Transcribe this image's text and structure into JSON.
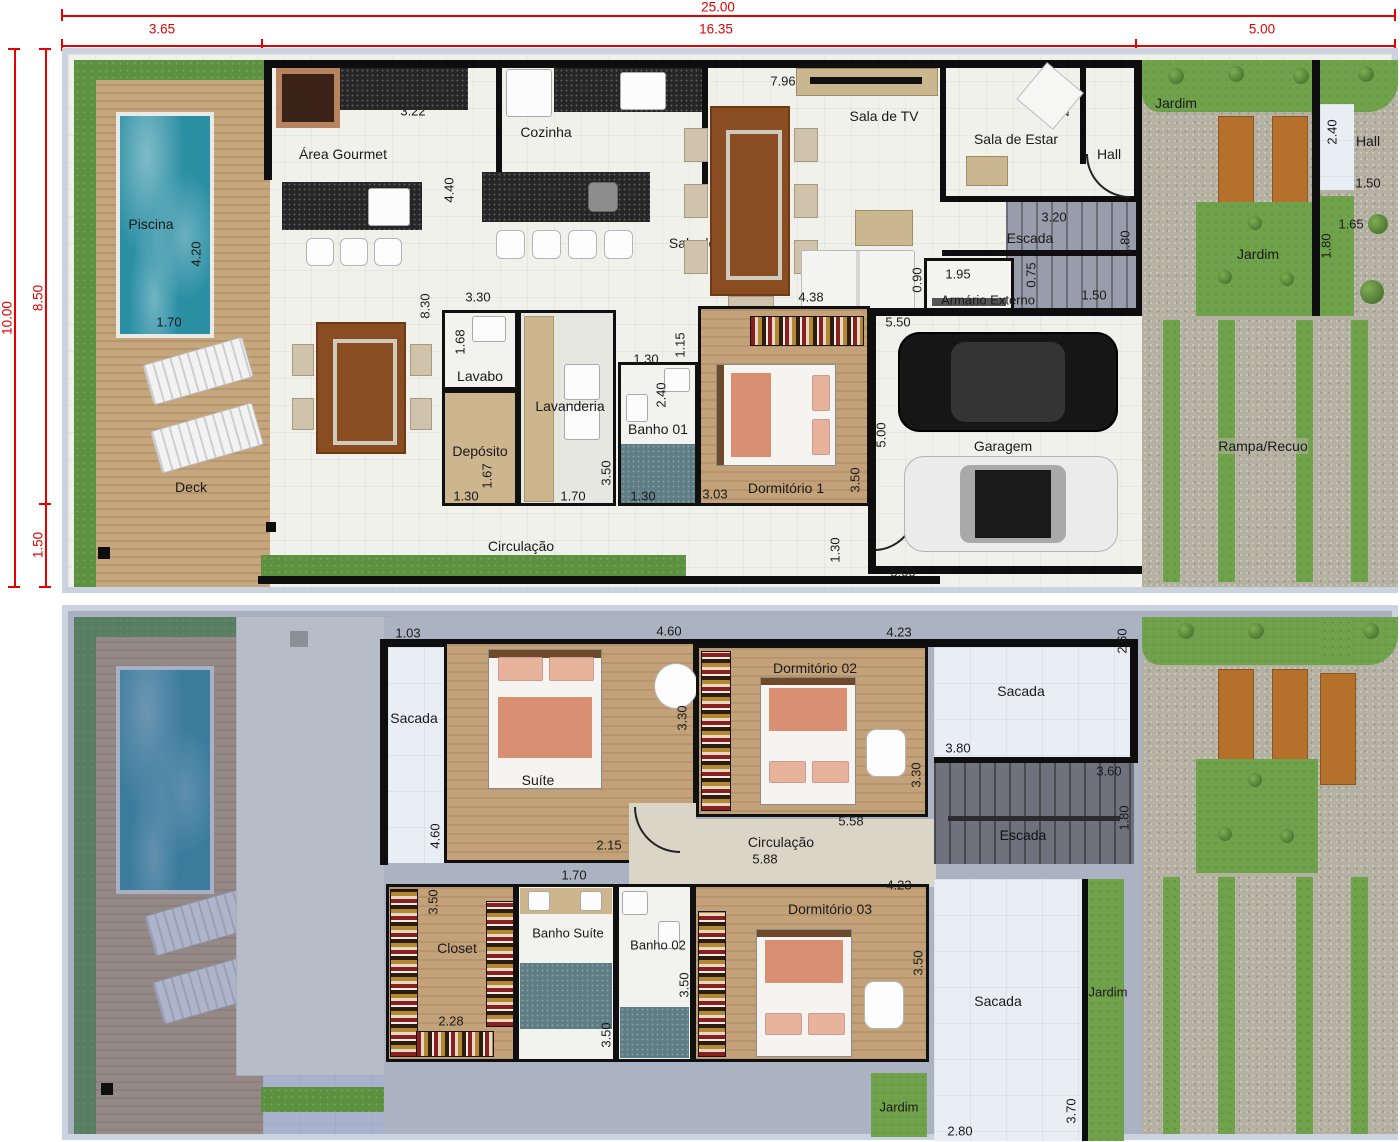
{
  "outer_dims": {
    "top_total": "25.00",
    "top_a": "3.65",
    "top_b": "16.35",
    "top_c": "5.00",
    "left_total": "10.00",
    "left_a": "8.50",
    "left_b": "1.50"
  },
  "floor1": {
    "rooms": {
      "piscina": "Piscina",
      "deck": "Deck",
      "area_gourmet": "Área Gourmet",
      "cozinha": "Cozinha",
      "sala_jantar": "Sala de Jantar",
      "sala_tv": "Sala de TV",
      "sala_estar": "Sala de Estar",
      "hall": "Hall",
      "hall_ext": "Hall",
      "jardim_top": "Jardim",
      "jardim_right": "Jardim",
      "escada": "Escada",
      "armario": "Armário Externo",
      "lavabo": "Lavabo",
      "lavanderia": "Lavanderia",
      "deposito": "Depósito",
      "banho01": "Banho 01",
      "dorm1": "Dormitório 1",
      "circulacao": "Circulação",
      "garagem": "Garagem",
      "rampa": "Rampa/Recuo"
    },
    "dims": {
      "pool_h": "4.20",
      "pool_w": "1.70",
      "gourmet_w": "3.22",
      "gourmet_h": "8.30",
      "cozinha_w": "3.67",
      "cozinha_h": "4.40",
      "tv_w": "7.96",
      "estar_h": "2.40",
      "svc_w": "3.30",
      "lavabo_h": "1.68",
      "lavabo_w": "1.30",
      "lavanderia_w": "1.70",
      "lavanderia_h": "3.50",
      "deposito_h": "1.67",
      "deposito_w": "1.30",
      "banho_w_top": "1.30",
      "banho_h": "2.40",
      "banho_w_bot": "1.30",
      "dorm1_entry": "1.15",
      "dorm1_w": "3.03",
      "dorm1_h": "3.50",
      "dorm1_door": "1.30",
      "sofa_w": "4.38",
      "sofa_h": "0.90",
      "garagem_top": "5.50",
      "garagem_side": "5.00",
      "garagem_bot": "5.00",
      "escada_w": "3.20",
      "escada_h": "1.80",
      "escada_b": "1.50",
      "armario_w": "1.95",
      "armario_h": "0.75",
      "hall_ext_h": "2.40",
      "hall_ext_w": "1.50",
      "jardim_w": "1.65",
      "jardim_h": "1.80"
    }
  },
  "floor2": {
    "rooms": {
      "sacada_left": "Sacada",
      "suite": "Suíte",
      "dorm2": "Dormitório 02",
      "sacada_tr": "Sacada",
      "escada": "Escada",
      "circulacao": "Circulação",
      "closet": "Closet",
      "banho_suite": "Banho Suíte",
      "banho02": "Banho 02",
      "dorm3": "Dormitório 03",
      "sacada_b": "Sacada",
      "jardim_small": "Jardim",
      "jardim_strip": "Jardim"
    },
    "dims": {
      "sacada_w": "1.03",
      "sacada_h1": "4.60",
      "sacada_h2": "4.60",
      "suite_w": "4.60",
      "suite_h": "3.30",
      "suite_closet": "2.15",
      "suite_v": "5.00",
      "banho_s_door": "1.70",
      "banho2_door": "1.30",
      "dorm2_w": "4.23",
      "dorm2_h": "3.30",
      "sacada_tr_h": "2.60",
      "sacada_tr_w": "3.80",
      "escada_w": "3.60",
      "escada_h": "1.80",
      "circ_a": "5.58",
      "circ_b": "5.88",
      "closet_h": "3.50",
      "closet_w": "2.28",
      "banho_s_h": "3.50",
      "banho2_h": "3.50",
      "dorm3_w": "4.23",
      "dorm3_h": "3.50",
      "sacada_b_w": "2.80",
      "sacada_b_h": "3.70"
    }
  }
}
